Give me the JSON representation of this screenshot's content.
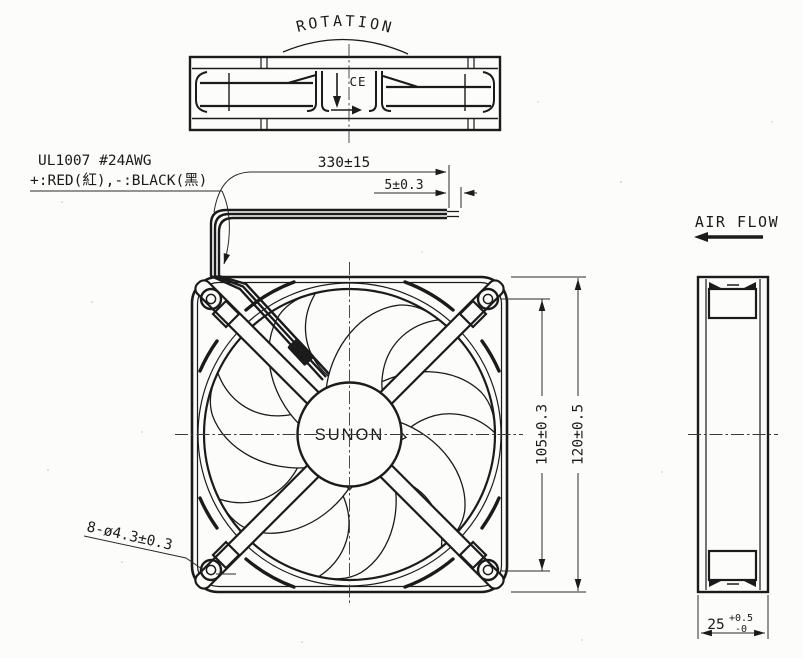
{
  "drawing": {
    "labels": {
      "rotation": "ROTATION",
      "air_flow": "AIR FLOW",
      "hub_brand": "SUNON",
      "ce_mark": "CE"
    },
    "wire_spec": {
      "line1": "UL1007 #24AWG",
      "line2": "+:RED(紅),-:BLACK(黑)"
    },
    "dimensions": {
      "lead_length": "330±15",
      "strip_length": "5±0.3",
      "hole_pitch": "105±0.3",
      "frame_size": "120±0.5",
      "thickness_value": "25",
      "thickness_tol_plus": "+0.5",
      "thickness_tol_minus": "-0",
      "mounting_holes": "8-ø4.3±0.3"
    },
    "colors": {
      "line": "#1b1b1b",
      "background": "#fcfcfb"
    }
  }
}
